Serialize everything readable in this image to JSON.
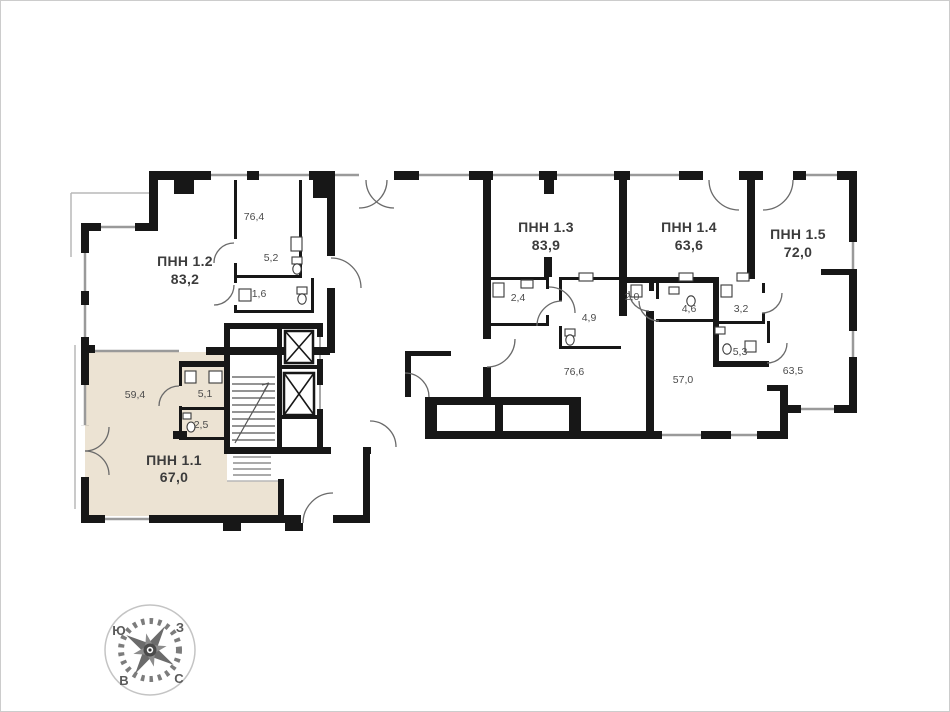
{
  "plan": {
    "type": "floorplan",
    "units": [
      {
        "id": "pnn-1-1",
        "name": "ПНН 1.1",
        "area": "67,0",
        "highlighted": true,
        "highlight_fill": "#ece3d3"
      },
      {
        "id": "pnn-1-2",
        "name": "ПНН 1.2",
        "area": "83,2",
        "highlighted": false
      },
      {
        "id": "pnn-1-3",
        "name": "ПНН 1.3",
        "area": "83,9",
        "highlighted": false
      },
      {
        "id": "pnn-1-4",
        "name": "ПНН 1.4",
        "area": "63,6",
        "highlighted": false
      },
      {
        "id": "pnn-1-5",
        "name": "ПНН 1.5",
        "area": "72,0",
        "highlighted": false
      }
    ],
    "rooms": [
      {
        "id": "room-76-4",
        "area": "76,4"
      },
      {
        "id": "room-5-2",
        "area": "5,2"
      },
      {
        "id": "room-1-6",
        "area": "1,6"
      },
      {
        "id": "room-59-4",
        "area": "59,4"
      },
      {
        "id": "room-5-1",
        "area": "5,1"
      },
      {
        "id": "room-2-5",
        "area": "2,5"
      },
      {
        "id": "room-2-4",
        "area": "2,4"
      },
      {
        "id": "room-4-9",
        "area": "4,9"
      },
      {
        "id": "room-76-6",
        "area": "76,6"
      },
      {
        "id": "room-2-0",
        "area": "2,0"
      },
      {
        "id": "room-4-6",
        "area": "4,6"
      },
      {
        "id": "room-57-0",
        "area": "57,0"
      },
      {
        "id": "room-3-2",
        "area": "3,2"
      },
      {
        "id": "room-5-3",
        "area": "5,3"
      },
      {
        "id": "room-63-5",
        "area": "63,5"
      }
    ],
    "colors": {
      "wall": "#171717",
      "window_line": "#9a9a9a",
      "door_arc": "#6a6a6a",
      "highlight_fill": "#ece3d3",
      "label": "#3c3c3c"
    }
  },
  "compass": {
    "top_left": "Ю",
    "top_right": "З",
    "bottom_left": "В",
    "bottom_right": "С"
  }
}
